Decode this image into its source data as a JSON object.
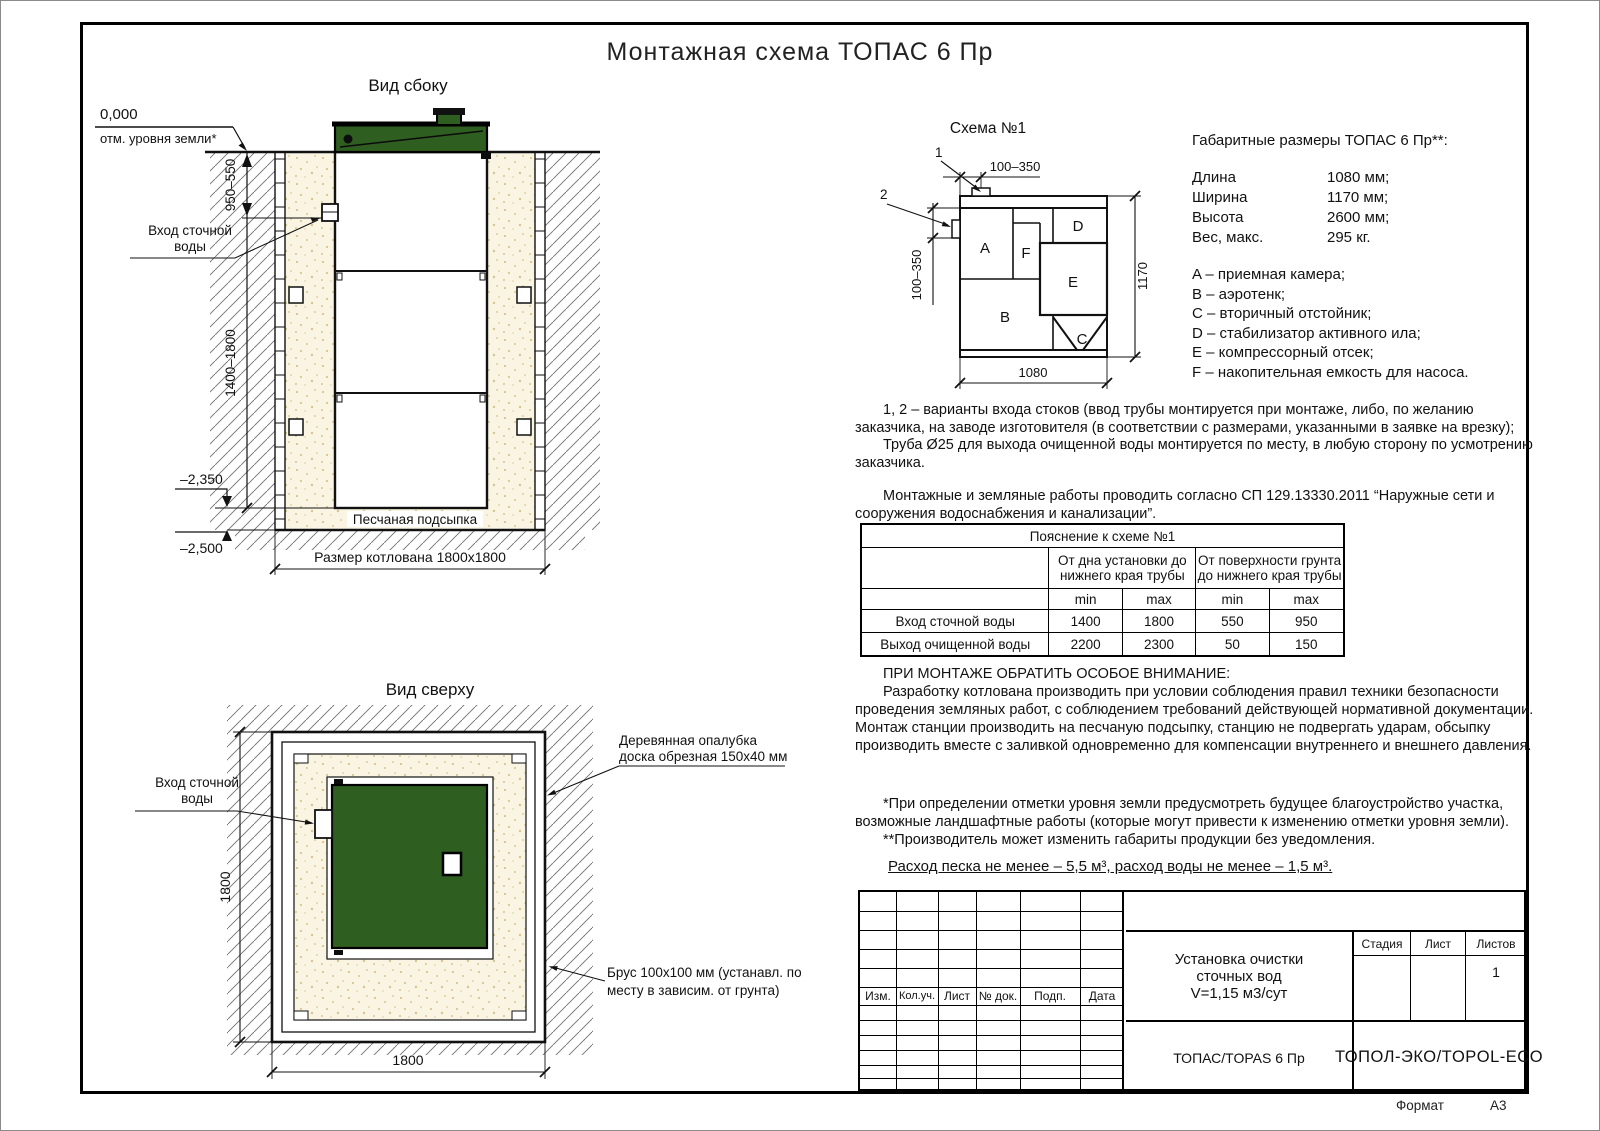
{
  "page": {
    "title": "Монтажная схема ТОПАС 6 Пр",
    "format_label": "Формат",
    "format_value": "А3"
  },
  "side_view": {
    "title": "Вид сбоку",
    "zero_level": "0,000",
    "zero_caption": "отм. уровня земли*",
    "dim_upper": "950–550",
    "dim_lower": "1400–1800",
    "inlet_line1": "Вход сточной",
    "inlet_line2": "воды",
    "level_2350": "–2,350",
    "level_2500": "–2,500",
    "sand_label": "Песчаная подсыпка",
    "pit_label": "Размер котлована 1800х1800"
  },
  "schema": {
    "title": "Схема №1",
    "marker1": "1",
    "marker2": "2",
    "dim_top": "100–350",
    "dim_left": "100–350",
    "dim_right": "1170",
    "dim_bottom": "1080",
    "a": "A",
    "b": "B",
    "c": "C",
    "d": "D",
    "e": "E",
    "f": "F"
  },
  "specs": {
    "title": "Габаритные размеры ТОПАС 6 Пр**:",
    "rows": [
      {
        "label": "Длина",
        "value": "1080 мм;"
      },
      {
        "label": "Ширина",
        "value": "1170 мм;"
      },
      {
        "label": "Высота",
        "value": "2600 мм;"
      },
      {
        "label": "Вес, макс.",
        "value": "295 кг."
      }
    ],
    "legend": [
      "A – приемная камера;",
      "B – аэротенк;",
      "C – вторичный отстойник;",
      "D – стабилизатор активного ила;",
      "E – компрессорный отсек;",
      "F – накопительная емкость для насоса."
    ]
  },
  "notes": {
    "variants": "1, 2 – варианты входа  стоков (ввод трубы монтируется при монтаже, либо, по желанию заказчика, на заводе изготовителя (в соответствии с размерами, указанными в заявке на врезку);",
    "pipe": "Труба Ø25 для выхода очищенной воды монтируется по месту, в любую сторону по усмотрению заказчика.",
    "sp": "Монтажные и земляные работы проводить согласно СП 129.13330.2011 “Наружные сети и сооружения водоснабжения и канализации”."
  },
  "table": {
    "title": "Пояснение к схеме №1",
    "group1": "От дна установки до нижнего края трубы",
    "group2": "От поверхности грунта до нижнего края трубы",
    "min1": "min",
    "max1": "max",
    "min2": "min",
    "max2": "max",
    "rows": [
      {
        "name": "Вход сточной воды",
        "v0": "1400",
        "v1": "1800",
        "v2": "550",
        "v3": "950"
      },
      {
        "name": "Выход очищенной воды",
        "v0": "2200",
        "v1": "2300",
        "v2": "50",
        "v3": "150"
      }
    ]
  },
  "attention": {
    "heading": "ПРИ МОНТАЖЕ ОБРАТИТЬ ОСОБОЕ ВНИМАНИЕ:",
    "body": "Разработку котлована производить при условии соблюдения правил техники безопасности проведения земляных работ, с соблюдением требований действующей нормативной документации. Монтаж станции производить на песчаную подсыпку, станцию не подвергать ударам, обсыпку производить вместе с заливкой одновременно для компенсации внутреннего и внешнего давления.",
    "footnote1": "*При определении отметки уровня земли предусмотреть будущее благоустройство участка, возможные ландшафтные работы (которые могут привести к изменению отметки уровня земли).",
    "footnote2": "**Производитель может изменить габариты продукции без уведомления.",
    "consumption": "Расход песка не менее – 5,5 м³, расход воды не менее – 1,5 м³."
  },
  "top_view": {
    "title": "Вид сверху",
    "inlet_line1": "Вход сточной",
    "inlet_line2": "воды",
    "formwork_line1": "Деревянная опалубка",
    "formwork_line2": "доска обрезная 150х40 мм",
    "beam_line1": "Брус 100х100 мм (устанавл. по",
    "beam_line2": "месту в зависим. от грунта)",
    "dim_left": "1800",
    "dim_bottom": "1800"
  },
  "title_block": {
    "rev0": "Изм.",
    "rev1": "Кол.уч.",
    "rev2": "Лист",
    "rev3": "№ док.",
    "rev4": "Подп.",
    "rev5": "Дата",
    "doc1": "Установка очистки",
    "doc2": "сточных вод",
    "doc3": "V=1,15 м3/сут",
    "model": "ТОПАС/TOPAS 6 Пр",
    "stage": "Стадия",
    "sheet": "Лист",
    "sheets": "Листов",
    "sheets_value": "1",
    "company": "ТОПОЛ-ЭКО/TOPOL-ECO"
  },
  "colors": {
    "lid_green": "#2e5e20",
    "sand": "#f9f5e2",
    "line": "#111111"
  }
}
